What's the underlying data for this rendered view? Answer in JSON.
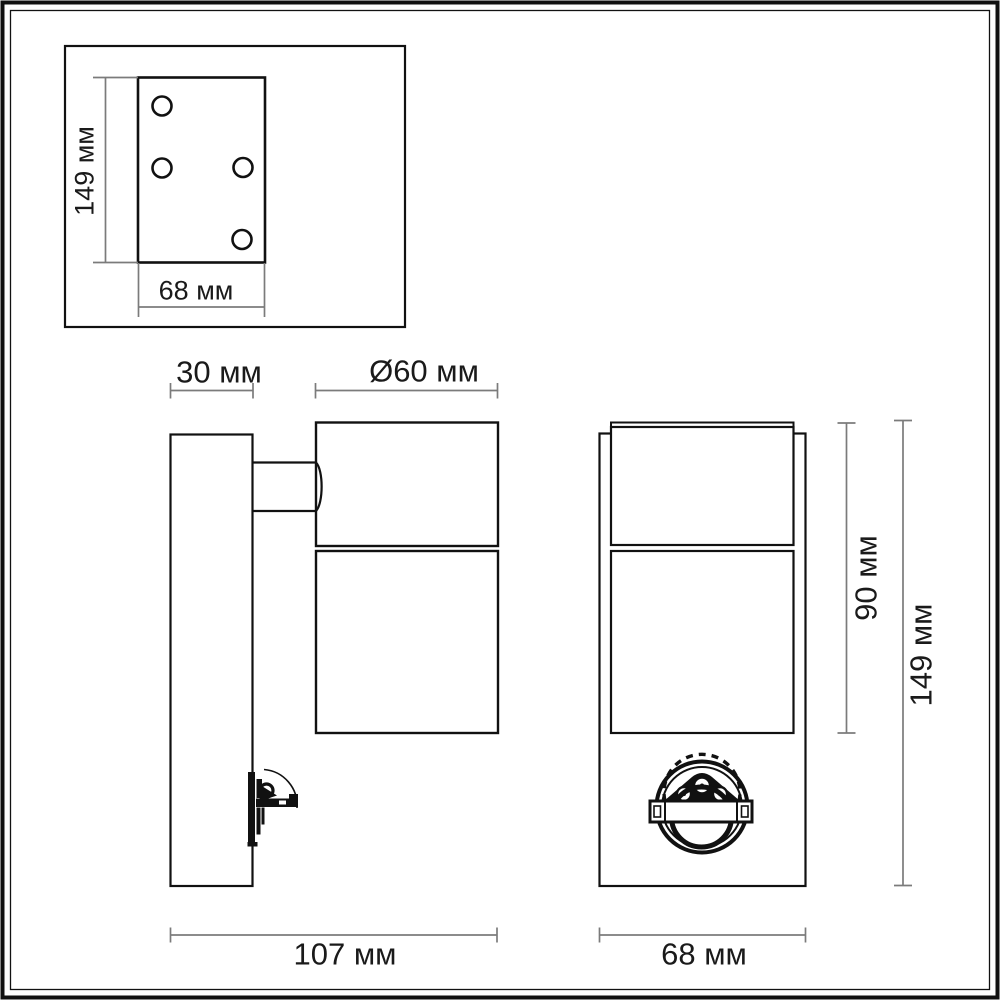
{
  "views": {
    "mounting_plate": {
      "height": "149 мм",
      "width": "68 мм",
      "holes": 4
    },
    "side": {
      "plate_depth": "30 мм",
      "diameter": "Ø60 мм",
      "overall_depth": "107 мм"
    },
    "front": {
      "body_height": "90 мм",
      "overall_height": "149 мм",
      "width": "68 мм"
    }
  },
  "colors": {
    "outline": "#111111",
    "dimension_line": "#7b7b7b",
    "text": "#1a1a1a",
    "background": "#ffffff"
  }
}
